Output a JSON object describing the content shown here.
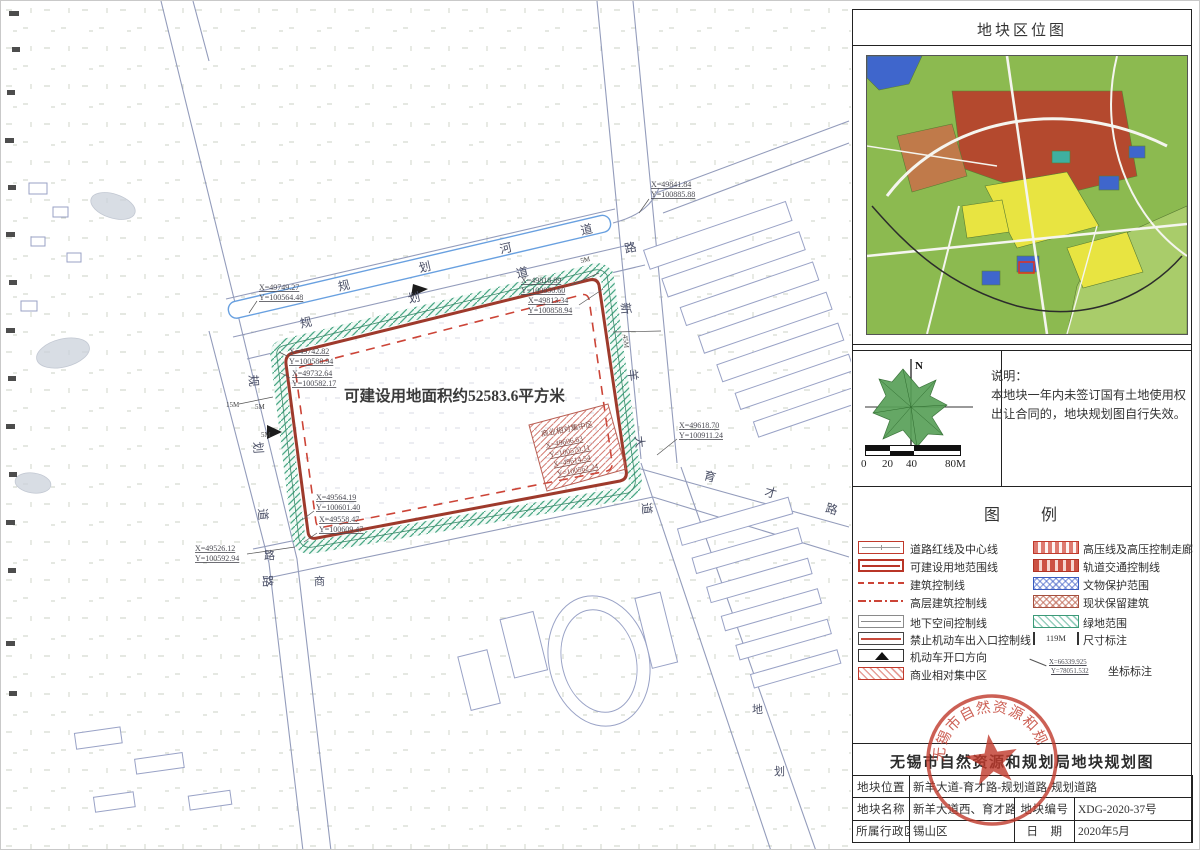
{
  "panel": {
    "region_map_title": "地块区位图",
    "region_map_palette": {
      "base_green": "#8cba50",
      "red_zone": "#b4492e",
      "brown_zone": "#c07a4a",
      "yellow_zone": "#e8e441",
      "blue_zone": "#3f66cc",
      "light_green": "#a9cc6a",
      "teal": "#3fb0a0"
    },
    "compass": {
      "north_label": "N"
    },
    "notes": {
      "title": "说明：",
      "line1": "本地块一年内未签订国有土地使用权",
      "line2": "出让合同的，地块规划图自行失效。"
    },
    "scale_bar": {
      "labels": [
        "0",
        "20",
        "40",
        "80M"
      ]
    },
    "legend": {
      "title": "图　　例",
      "left": [
        {
          "label": "道路红线及中心线"
        },
        {
          "label": "可建设用地范围线"
        },
        {
          "label": "建筑控制线"
        },
        {
          "label": "高层建筑控制线"
        },
        {
          "label": "地下空间控制线"
        },
        {
          "label": "禁止机动车出入口控制线"
        },
        {
          "label": "机动车开口方向"
        },
        {
          "label": "商业相对集中区"
        }
      ],
      "right": [
        {
          "label": "高压线及高压控制走廊"
        },
        {
          "label": "轨道交通控制线"
        },
        {
          "label": "文物保护范围"
        },
        {
          "label": "现状保留建筑"
        },
        {
          "label": "绿地范围"
        },
        {
          "label": "尺寸标注",
          "value": "119M"
        },
        {
          "label": "坐标标注",
          "x": "X=66339.925",
          "y": "Y=78051.532"
        }
      ]
    }
  },
  "title_block": {
    "bureau_title": "无锡市自然资源和规划局地块规划图",
    "stamp_text": "无锡市自然资源和规划局",
    "fields": {
      "location_label": "地块位置",
      "location_value": "新羊大道-育才路-规划道路-规划道路",
      "name_label": "地块名称",
      "name_value": "新羊大道西、育才路北地块",
      "code_label": "地块编号",
      "code_value": "XDG-2020-37号",
      "district_label": "所属行政区",
      "district_value": "锡山区",
      "date_label": "日　期",
      "date_value": "2020年5月"
    }
  },
  "map": {
    "area_label": "可建设用地面积约52583.6平方米",
    "commercial": {
      "label": "商业相对集中区",
      "c1x": "X=49606.63",
      "c1y": "Y=100570.11",
      "c2x": "X=49614.54",
      "c2y": "Y=100562.24"
    },
    "road_labels": [
      {
        "text": "规 划 河 道"
      },
      {
        "text": "规 划 道 路"
      },
      {
        "text": "新 羊 大 道"
      },
      {
        "text": "育 才 路"
      },
      {
        "text": "规 划 道 路"
      },
      {
        "text": "路"
      },
      {
        "text": "商"
      },
      {
        "text": "地"
      },
      {
        "text": "划"
      }
    ],
    "dimensions": [
      "5M",
      "15M",
      "5M",
      "5M",
      "45M"
    ],
    "coordinates": [
      {
        "x": "X=49841.84",
        "y": "Y=100885.88"
      },
      {
        "x": "X=49818.89",
        "y": "Y=100850.60"
      },
      {
        "x": "X=49813.34",
        "y": "Y=100858.94"
      },
      {
        "x": "X=49742.82",
        "y": "Y=100588.94"
      },
      {
        "x": "X=49732.64",
        "y": "Y=100582.17"
      },
      {
        "x": "X=49618.70",
        "y": "Y=100911.24"
      },
      {
        "x": "X=49564.19",
        "y": "Y=100601.40"
      },
      {
        "x": "X=49558.47",
        "y": "Y=100609.47"
      },
      {
        "x": "X=49526.12",
        "y": "Y=100592.94"
      },
      {
        "x": "X=49749.27",
        "y": "Y=100564.48"
      }
    ]
  }
}
